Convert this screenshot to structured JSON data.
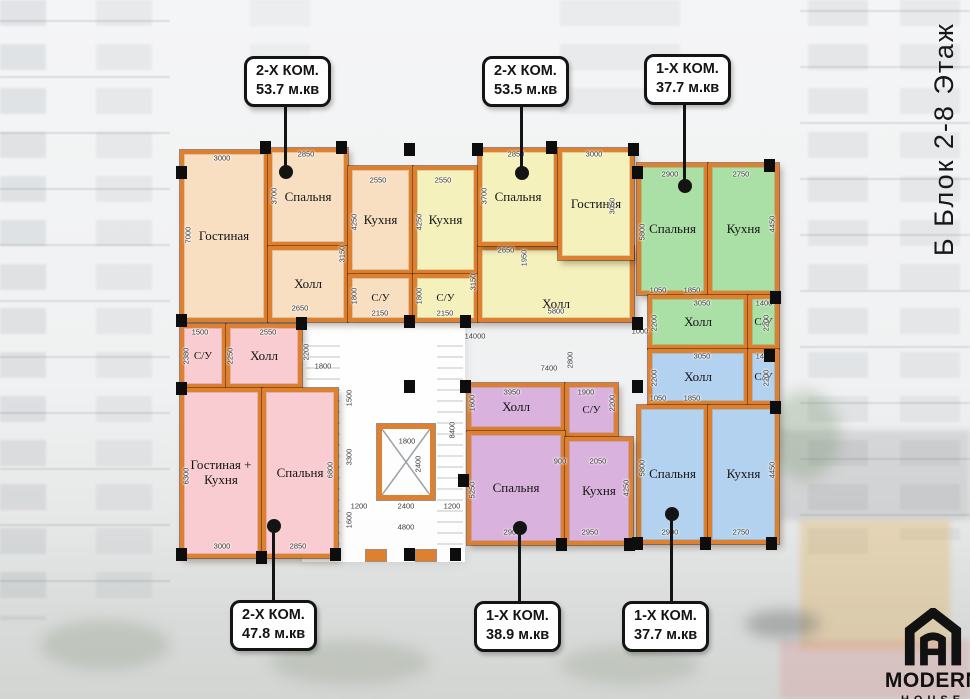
{
  "side_title": "Б Блок 2-8 Этаж",
  "logo": {
    "brand": "MODERN",
    "sub": "HOUSE",
    "icon": "house-monogram-icon"
  },
  "callouts": [
    {
      "type": "2-Х КОМ.",
      "area": "53.7 м.кв"
    },
    {
      "type": "2-Х КОМ.",
      "area": "53.5 м.кв"
    },
    {
      "type": "1-Х КОМ.",
      "area": "37.7 м.кв"
    },
    {
      "type": "2-Х КОМ.",
      "area": "47.8 м.кв"
    },
    {
      "type": "1-Х КОМ.",
      "area": "38.9 м.кв"
    },
    {
      "type": "1-Х КОМ.",
      "area": "37.7 м.кв"
    }
  ],
  "apartments": [
    {
      "position": "top-left",
      "type": "2-Х КОМ.",
      "area": "53.7 м.кв",
      "color": "#f8dfc2",
      "rooms": [
        "Гостиная",
        "Спальня",
        "Холл",
        "Кухня",
        "С/У"
      ]
    },
    {
      "position": "top-middle",
      "type": "2-Х КОМ.",
      "area": "53.5 м.кв",
      "color": "#f5f1bd",
      "rooms": [
        "Кухня",
        "С/У",
        "Спальня",
        "Гостиная",
        "Холл"
      ]
    },
    {
      "position": "top-right",
      "type": "1-Х КОМ.",
      "area": "37.7 м.кв",
      "color": "#aadfa5",
      "rooms": [
        "Спальня",
        "Кухня",
        "Холл",
        "С/У"
      ]
    },
    {
      "position": "bottom-right",
      "type": "1-Х КОМ.",
      "area": "37.7 м.кв",
      "color": "#b3d2f0",
      "rooms": [
        "Холл",
        "С/У",
        "Спальня",
        "Кухня"
      ]
    },
    {
      "position": "bottom-middle",
      "type": "1-Х КОМ.",
      "area": "38.9 м.кв",
      "color": "#d9b3de",
      "rooms": [
        "Холл",
        "С/У",
        "Спальня",
        "Кухня"
      ]
    },
    {
      "position": "bottom-left",
      "type": "2-Х КОМ.",
      "area": "47.8 м.кв",
      "color": "#f8ccd1",
      "rooms": [
        "С/У",
        "Холл",
        "Гостиная + Кухня",
        "Спальня"
      ]
    }
  ],
  "colors": {
    "wall": "#dd8130",
    "callout_border": "#141414",
    "dim_text": "#3a3a3a"
  },
  "dims": [
    [
      "3000",
      222,
      158,
      0
    ],
    [
      "2850",
      306,
      154,
      0
    ],
    [
      "2550",
      378,
      180,
      0
    ],
    [
      "2550",
      443,
      180,
      0
    ],
    [
      "2850",
      516,
      154,
      0
    ],
    [
      "3000",
      594,
      154,
      0
    ],
    [
      "2900",
      670,
      174,
      0
    ],
    [
      "2750",
      741,
      174,
      0
    ],
    [
      "7000",
      188,
      235,
      1
    ],
    [
      "3700",
      274,
      196,
      1
    ],
    [
      "4250",
      354,
      222,
      1
    ],
    [
      "1800",
      354,
      296,
      1
    ],
    [
      "2150",
      380,
      313,
      0
    ],
    [
      "2650",
      300,
      308,
      0
    ],
    [
      "3150",
      342,
      254,
      1
    ],
    [
      "4250",
      419,
      222,
      1
    ],
    [
      "1800",
      419,
      296,
      1
    ],
    [
      "2150",
      445,
      313,
      0
    ],
    [
      "3150",
      473,
      282,
      1
    ],
    [
      "1950",
      524,
      258,
      1
    ],
    [
      "2650",
      506,
      250,
      0
    ],
    [
      "5800",
      556,
      311,
      0
    ],
    [
      "3700",
      484,
      196,
      1
    ],
    [
      "3050",
      612,
      206,
      1
    ],
    [
      "5800",
      642,
      232,
      1
    ],
    [
      "4450",
      772,
      224,
      1
    ],
    [
      "1050",
      658,
      290,
      0
    ],
    [
      "1850",
      692,
      290,
      0
    ],
    [
      "3050",
      702,
      303,
      0
    ],
    [
      "1400",
      764,
      303,
      0
    ],
    [
      "2200",
      654,
      323,
      1
    ],
    [
      "2200",
      766,
      323,
      1
    ],
    [
      "1000",
      640,
      331,
      0
    ],
    [
      "14000",
      475,
      336,
      0
    ],
    [
      "1500",
      349,
      398,
      1
    ],
    [
      "3300",
      349,
      457,
      1
    ],
    [
      "1600",
      349,
      520,
      1
    ],
    [
      "8400",
      452,
      430,
      1
    ],
    [
      "1800",
      407,
      441,
      0
    ],
    [
      "2400",
      418,
      464,
      1
    ],
    [
      "1200",
      359,
      506,
      0
    ],
    [
      "2400",
      406,
      506,
      0
    ],
    [
      "1200",
      452,
      506,
      0
    ],
    [
      "4800",
      406,
      527,
      0
    ],
    [
      "2800",
      570,
      360,
      1
    ],
    [
      "7400",
      549,
      368,
      0
    ],
    [
      "2200",
      306,
      352,
      1
    ],
    [
      "1800",
      323,
      366,
      0
    ],
    [
      "3050",
      702,
      356,
      0
    ],
    [
      "1400",
      764,
      356,
      0
    ],
    [
      "2200",
      654,
      378,
      1
    ],
    [
      "2200",
      766,
      378,
      1
    ],
    [
      "1050",
      658,
      398,
      0
    ],
    [
      "1850",
      692,
      398,
      0
    ],
    [
      "5800",
      642,
      468,
      1
    ],
    [
      "4450",
      772,
      470,
      1
    ],
    [
      "2900",
      670,
      532,
      0
    ],
    [
      "2750",
      741,
      532,
      0
    ],
    [
      "3950",
      512,
      392,
      0
    ],
    [
      "1900",
      586,
      392,
      0
    ],
    [
      "1600",
      472,
      403,
      1
    ],
    [
      "2200",
      612,
      403,
      1
    ],
    [
      "900",
      560,
      461,
      0
    ],
    [
      "2050",
      598,
      461,
      0
    ],
    [
      "5250",
      472,
      490,
      1
    ],
    [
      "4250",
      626,
      488,
      1
    ],
    [
      "2900",
      512,
      532,
      0
    ],
    [
      "2950",
      590,
      532,
      0
    ],
    [
      "1500",
      200,
      332,
      0
    ],
    [
      "2550",
      268,
      332,
      0
    ],
    [
      "2380",
      186,
      356,
      1
    ],
    [
      "2250",
      230,
      356,
      1
    ],
    [
      "6300",
      186,
      476,
      1
    ],
    [
      "6800",
      330,
      470,
      1
    ],
    [
      "3000",
      222,
      546,
      0
    ],
    [
      "2850",
      298,
      546,
      0
    ]
  ],
  "columns": [
    [
      176,
      166
    ],
    [
      260,
      141
    ],
    [
      336,
      141
    ],
    [
      404,
      143
    ],
    [
      472,
      143
    ],
    [
      546,
      141
    ],
    [
      628,
      143
    ],
    [
      176,
      314
    ],
    [
      296,
      317
    ],
    [
      404,
      315
    ],
    [
      460,
      315
    ],
    [
      632,
      166
    ],
    [
      764,
      159
    ],
    [
      770,
      291
    ],
    [
      632,
      317
    ],
    [
      176,
      382
    ],
    [
      176,
      548
    ],
    [
      256,
      551
    ],
    [
      330,
      548
    ],
    [
      404,
      380
    ],
    [
      460,
      380
    ],
    [
      632,
      380
    ],
    [
      764,
      349
    ],
    [
      770,
      401
    ],
    [
      632,
      537
    ],
    [
      700,
      537
    ],
    [
      766,
      537
    ],
    [
      458,
      474
    ],
    [
      556,
      538
    ],
    [
      624,
      538
    ],
    [
      404,
      548
    ],
    [
      450,
      548
    ]
  ],
  "stubs": [
    [
      366,
      550
    ],
    [
      416,
      550
    ]
  ]
}
